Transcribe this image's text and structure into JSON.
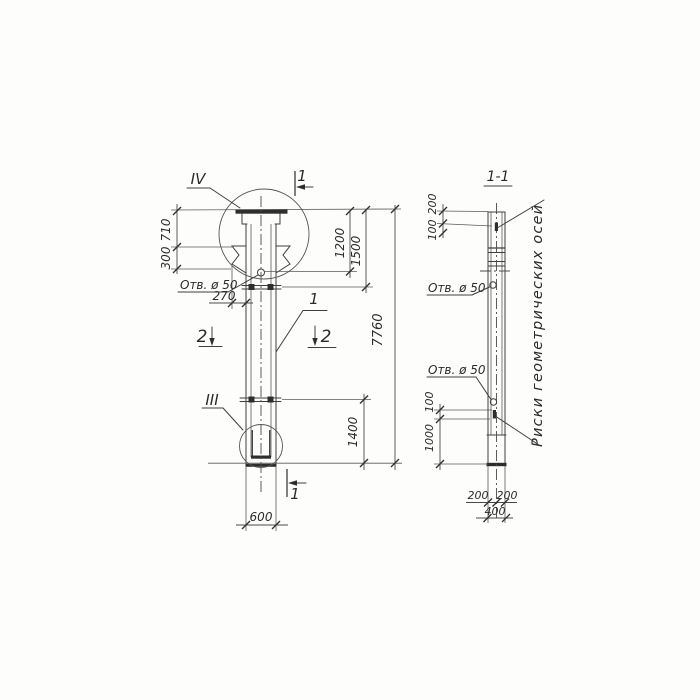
{
  "colors": {
    "ink": "#3e3e3e",
    "paper": "#fdfdfb"
  },
  "elevation": {
    "detail_top": "IV",
    "detail_bottom": "III",
    "cut1_top": "1",
    "cut1_bottom": "1",
    "cut2_left": "2",
    "cut2_right": "2",
    "part_label": "1",
    "hole_label": "Отв. ø 50",
    "dims": {
      "d710": "710",
      "d300": "300",
      "d270": "270",
      "d1200": "1200",
      "d1500": "1500",
      "d7760": "7760",
      "d1400": "1400",
      "d600": "600"
    }
  },
  "section": {
    "title": "1-1",
    "hole_label_upper": "Отв. ø 50",
    "hole_label_lower": "Отв. ø 50",
    "note": "Риски геометрических осей",
    "dims": {
      "d200_top": "200",
      "d100_top": "100",
      "d100_mid": "100",
      "d1000": "1000",
      "d200_left": "200",
      "d200_right": "200",
      "d400": "400"
    }
  }
}
